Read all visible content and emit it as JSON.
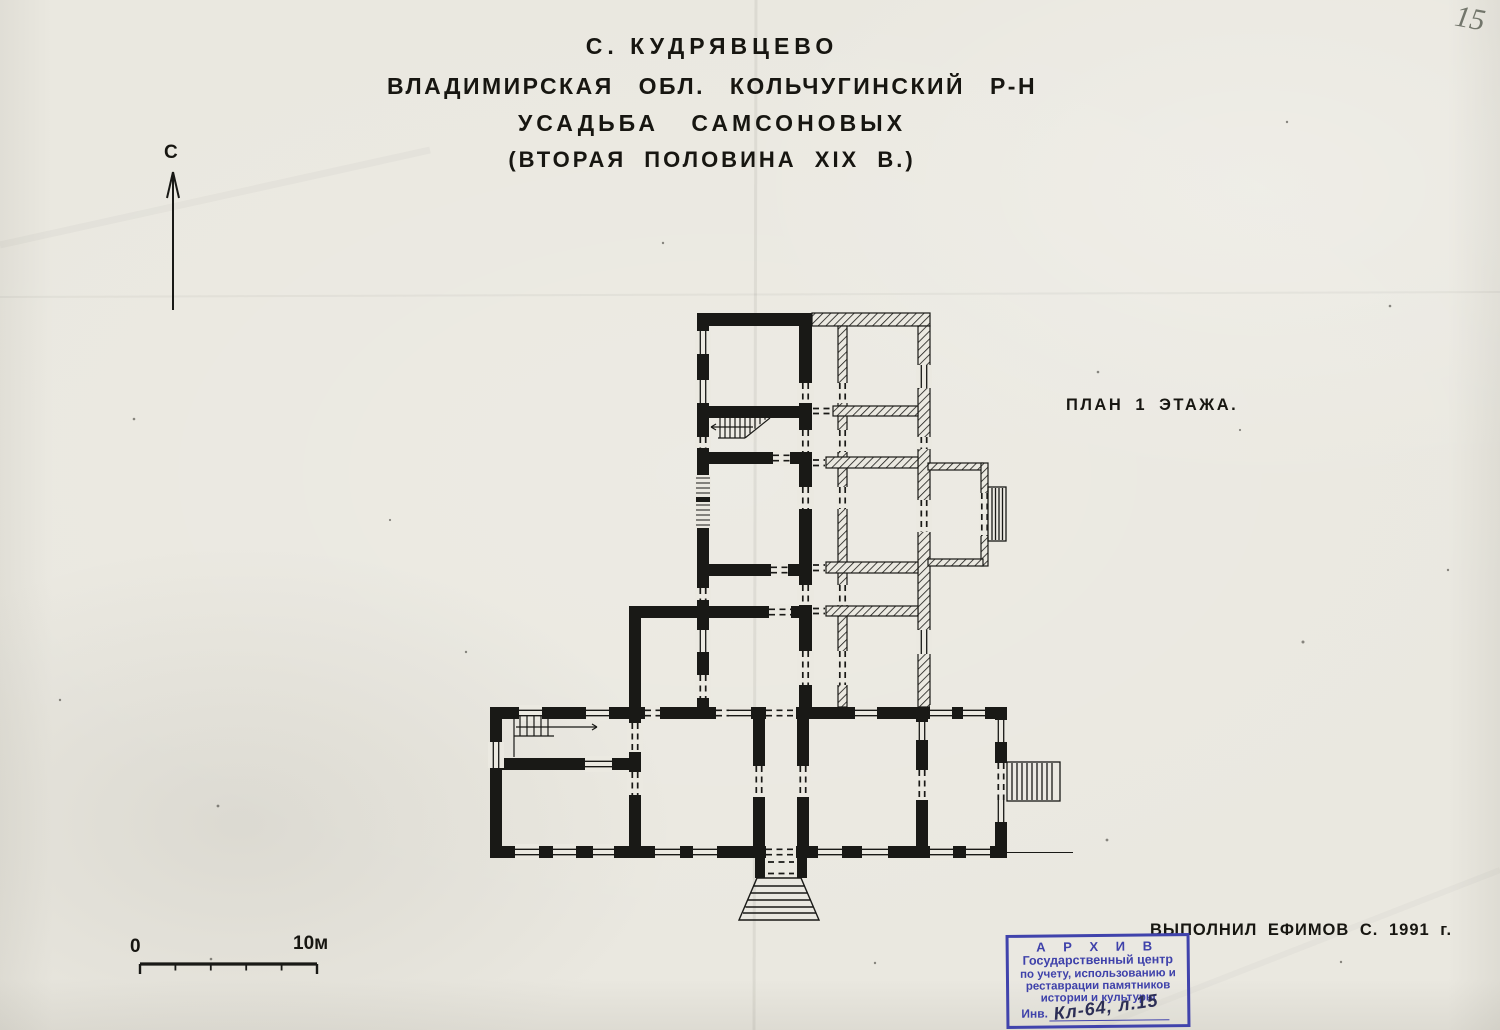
{
  "page": {
    "page_number": "15",
    "paper_color": "#eae8e0",
    "ink_color": "#191916",
    "stamp_color": "#4043ac"
  },
  "title_block": {
    "line1": "С. КУДРЯВЦЕВО",
    "line2": "ВЛАДИМИРСКАЯ ОБЛ. КОЛЬЧУГИНСКИЙ Р-Н",
    "line3": "УСАДЬБА САМСОНОВЫХ",
    "line4": "(ВТОРАЯ ПОЛОВИНА XIX В.)"
  },
  "plan": {
    "label": "ПЛАН 1 ЭТАЖА."
  },
  "north_indicator": {
    "label": "С"
  },
  "scale_bar": {
    "start_label": "0",
    "end_label": "10м",
    "length_meters": 10,
    "segments": 5
  },
  "credit": {
    "text": "ВЫПОЛНИЛ ЕФИМОВ С. 1991 г."
  },
  "stamp": {
    "line1": "А Р Х И В",
    "line2": "Государственный центр",
    "line3": "по учету, использованию и",
    "line4": "реставрации памятников",
    "line5": "истории и культуры",
    "inv_label": "Инв.",
    "inv_number": "Кл-64, л.15"
  }
}
